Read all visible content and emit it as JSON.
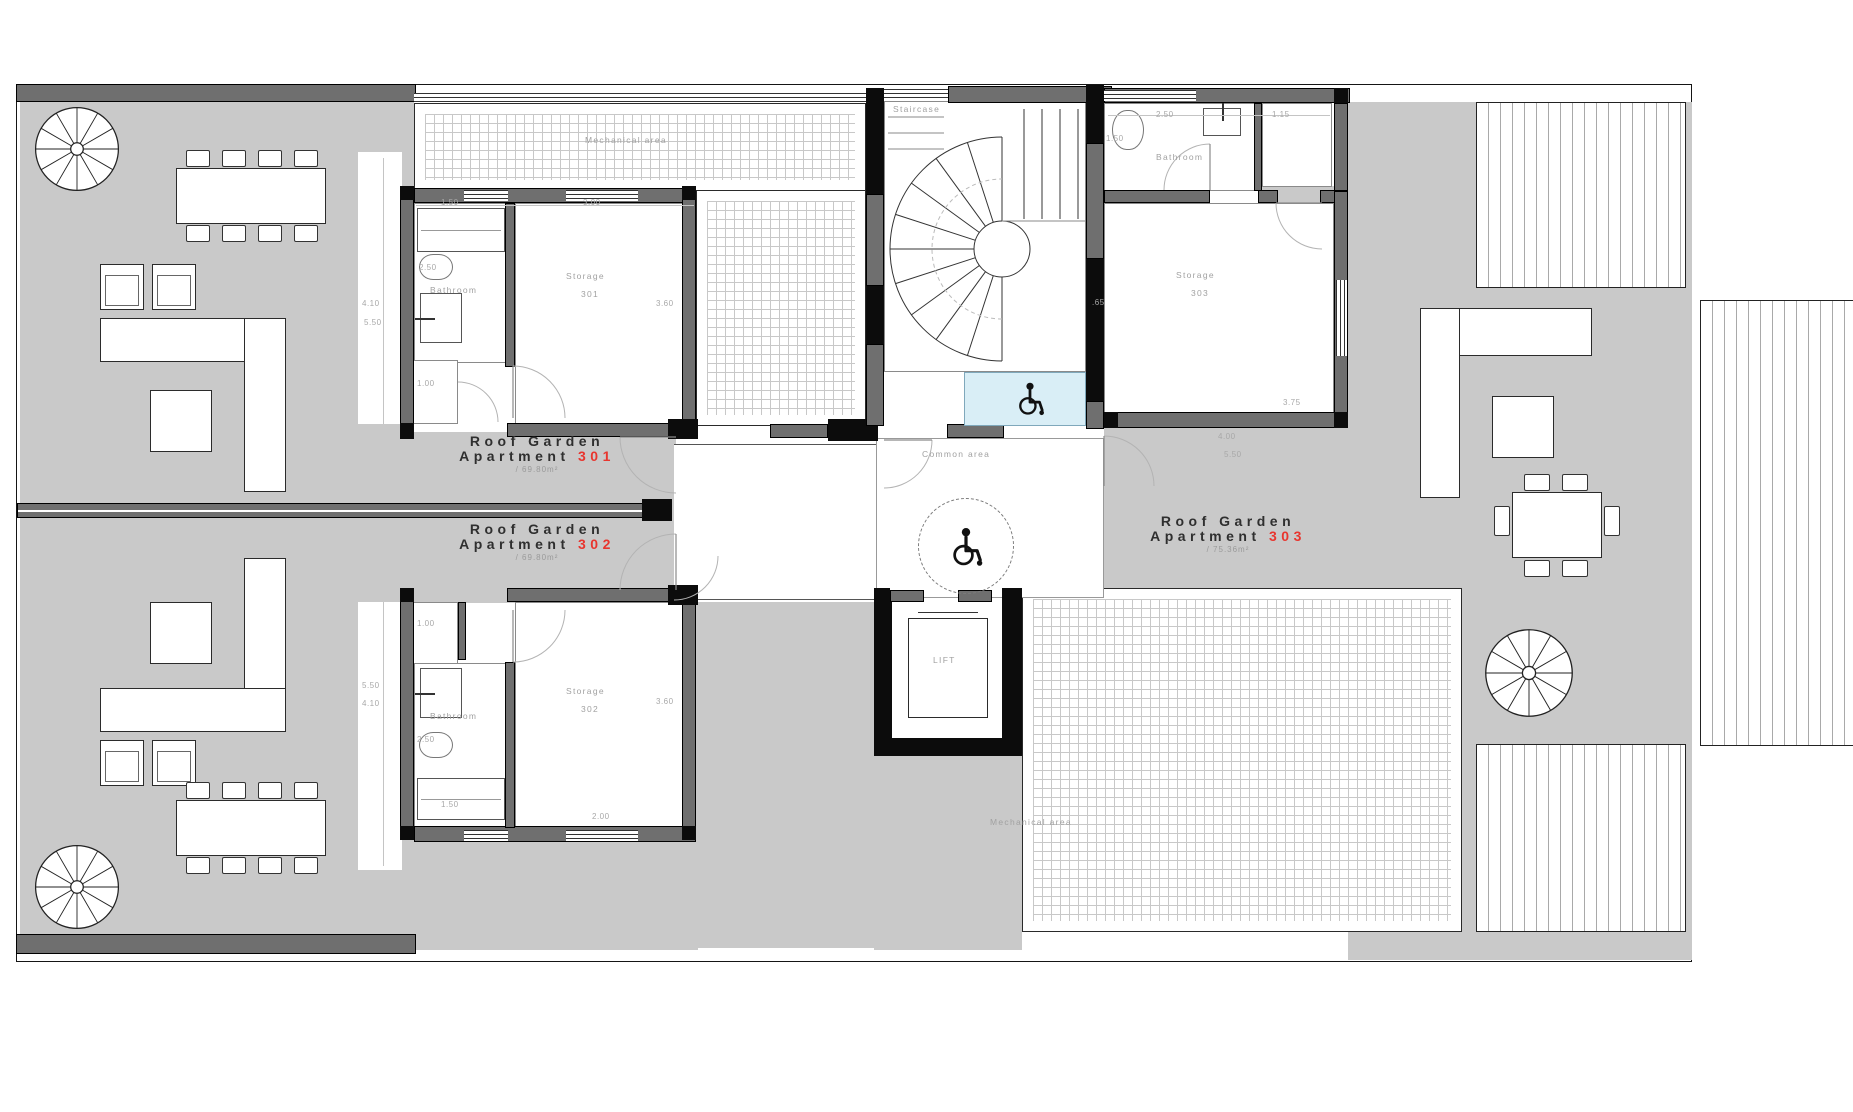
{
  "plan": {
    "apartments": [
      {
        "name": "Roof Garden",
        "type": "Apartment",
        "number": "301",
        "area": "/ 69.80m²"
      },
      {
        "name": "Roof Garden",
        "type": "Apartment",
        "number": "302",
        "area": "/ 69.80m²"
      },
      {
        "name": "Roof Garden",
        "type": "Apartment",
        "number": "303",
        "area": "/ 75.36m²"
      }
    ],
    "rooms": {
      "staircase": "Staircase",
      "lift": "LIFT",
      "common_area": "Common area",
      "mechanical_top": "Mechanical area",
      "mechanical_bottom": "Mechanical area",
      "bathroom_301": "Bathroom",
      "bathroom_302": "Bathroom",
      "bathroom_303": "Bathroom",
      "storage_301": {
        "name": "Storage",
        "number": "301"
      },
      "storage_302": {
        "name": "Storage",
        "number": "302"
      },
      "storage_303": {
        "name": "Storage",
        "number": "303"
      }
    },
    "dimensions": [
      {
        "t": "1.50"
      },
      {
        "t": "3.00"
      },
      {
        "t": "2.50"
      },
      {
        "t": "3.60"
      },
      {
        "t": "4.10"
      },
      {
        "t": "5.50"
      },
      {
        "t": "1.00"
      },
      {
        "t": "1.00"
      },
      {
        "t": "5.50"
      },
      {
        "t": "4.10"
      },
      {
        "t": "2.50"
      },
      {
        "t": "3.60"
      },
      {
        "t": "1.50"
      },
      {
        "t": "2.00"
      },
      {
        "t": "1.50"
      },
      {
        "t": "2.50"
      },
      {
        "t": "1.15"
      },
      {
        "t": ".65"
      },
      {
        "t": "3.75"
      },
      {
        "t": "4.00"
      },
      {
        "t": "5.50"
      }
    ],
    "colors": {
      "terrace": "#c9c9c9",
      "wall": "#6f6f6f",
      "accent_number": "#e8352e",
      "highlight_platform": "#d9eef6",
      "label": "#a1a1a1"
    }
  }
}
